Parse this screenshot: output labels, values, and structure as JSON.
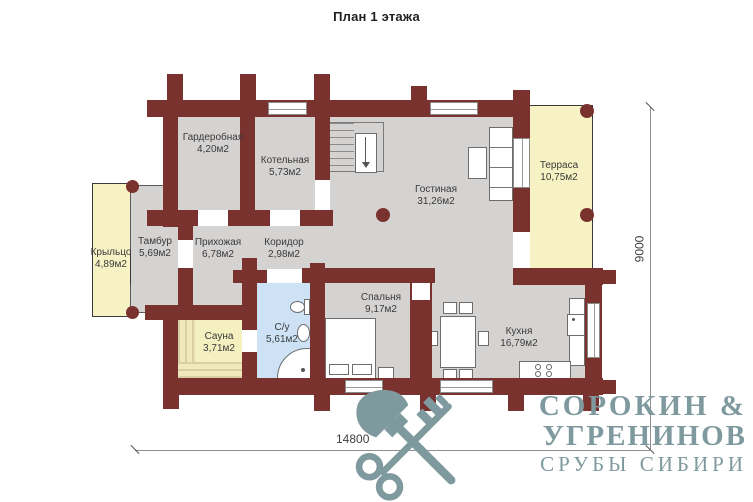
{
  "title": "План 1 этажа",
  "rooms": [
    {
      "name": "Гардеробная",
      "area": "4,20м2"
    },
    {
      "name": "Котельная",
      "area": "5,73м2"
    },
    {
      "name": "Гостиная",
      "area": "31,26м2"
    },
    {
      "name": "Терраса",
      "area": "10,75м2"
    },
    {
      "name": "Крыльцо",
      "area": "4,89м2"
    },
    {
      "name": "Тамбур",
      "area": "5,69м2"
    },
    {
      "name": "Прихожая",
      "area": "6,78м2"
    },
    {
      "name": "Коридор",
      "area": "2,98м2"
    },
    {
      "name": "Сауна",
      "area": "3,71м2"
    },
    {
      "name": "С/у",
      "area": "5,61м2"
    },
    {
      "name": "Спальня",
      "area": "9,17м2"
    },
    {
      "name": "Кухня",
      "area": "16,79м2"
    }
  ],
  "dimensions": {
    "horizontal": "14800",
    "vertical": "9000"
  },
  "logo": {
    "name_line1": "СОРОКИН &",
    "name_line2": "УГРЕНИНОВ",
    "tagline": "СРУБЫ СИБИРИ",
    "icon": "axe-and-key-icon"
  },
  "colors": {
    "wall": "#7a322e",
    "floor": "#d5d3d2",
    "outdoor": "#f6f2c4",
    "bathroom": "#cde2f5",
    "logo": "#7f9a9e"
  }
}
